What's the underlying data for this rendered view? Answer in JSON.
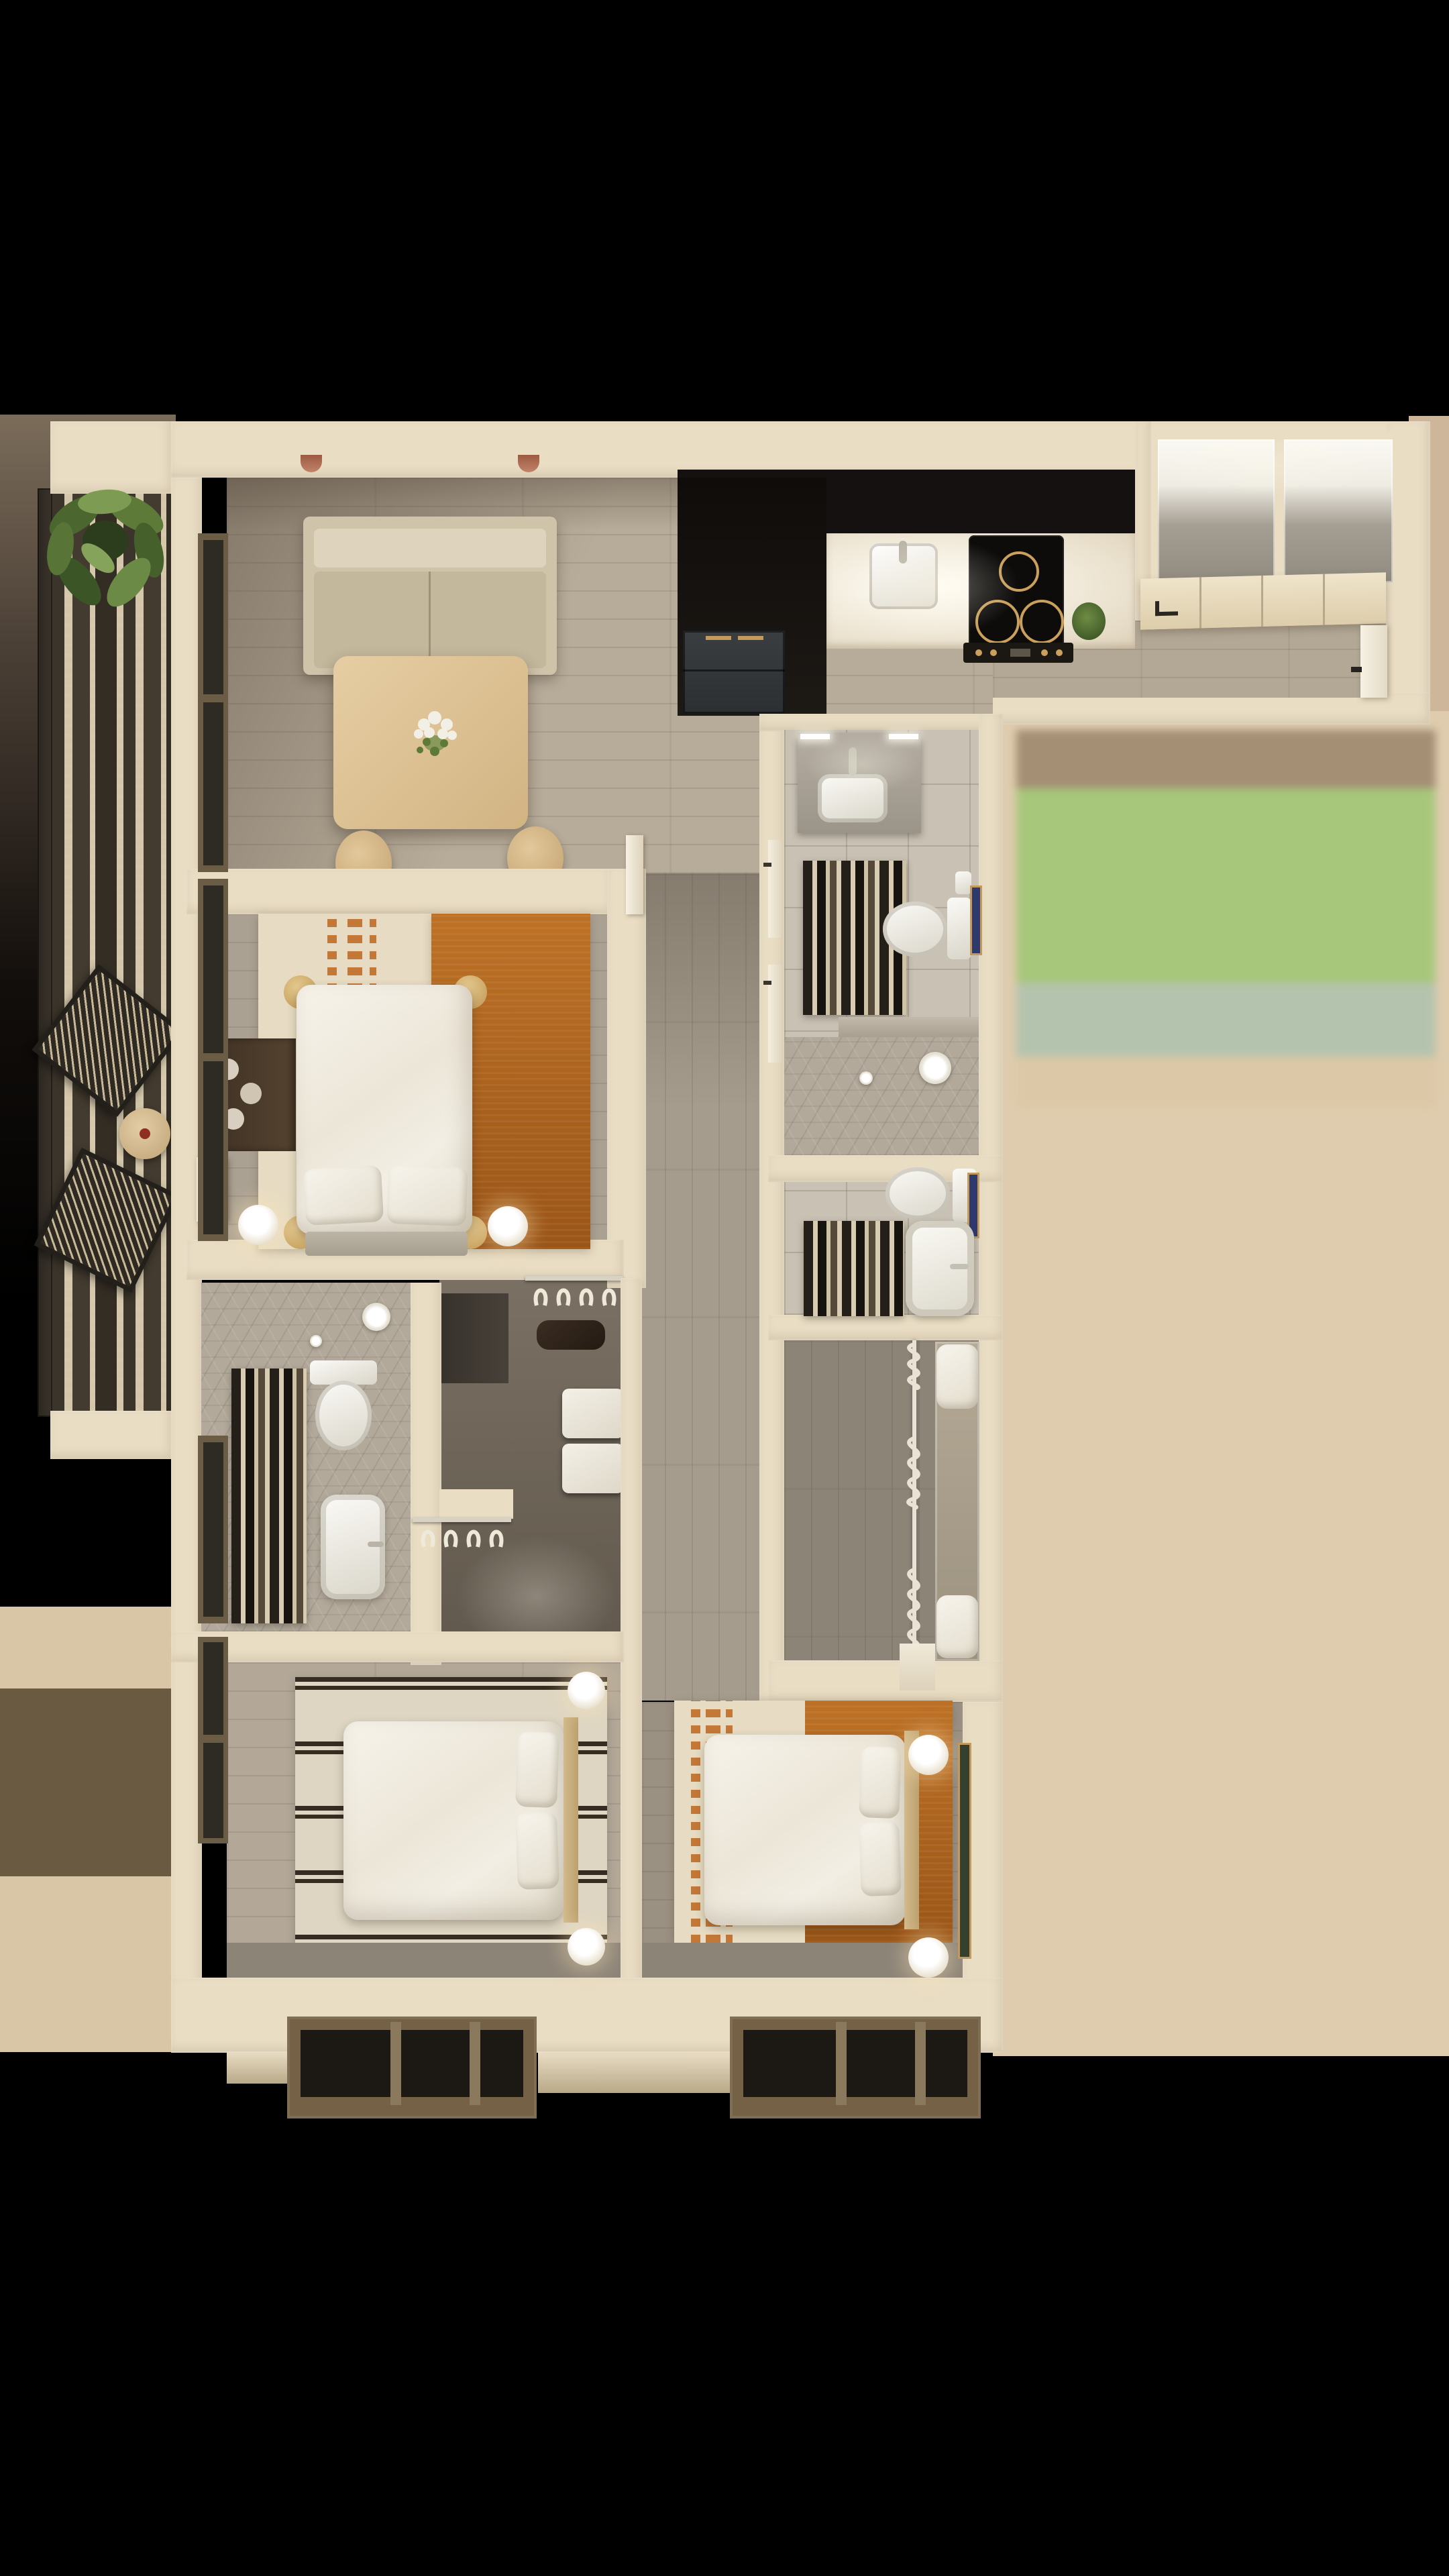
{
  "image_type": "3d-floor-plan-render",
  "palette": {
    "wall": "#e9ddc4",
    "wall-dark": "#d8c8aa",
    "wall-light": "#f7f0de",
    "floor-light": "#b7ab99",
    "floor-gray": "#a69c8d",
    "floor-br1": "#aba192",
    "floor-br3": "#9b9183",
    "floor-dark": "#6f665a",
    "floor-mid": "#8d8478",
    "tile": "#c9c2b4",
    "hex": "#b2a99b",
    "kitchen-black": "#141110",
    "appliance": "#35383b",
    "gold": "#c49a5c",
    "sofa": "#cfc3aa",
    "sofa-back": "#ded4bd",
    "sofa-seat": "#c3b79c",
    "wood-table": "#ddc398",
    "wood-head": "#d3ba8c",
    "white": "#f6f3ec",
    "rust": "#b2661f",
    "balcony-dark": "#3b342a",
    "balcony-cream": "#d3c6ab",
    "olive-frame": "#6a5c45",
    "pane": "#2e2a24",
    "plant-green": "#5d7a39",
    "plant-dark": "#3c5526",
    "court-brown": "#a48e74",
    "court-green": "#a7c77b",
    "court-sage": "#b4c3ad",
    "court-tan": "#dcc8a7",
    "bg-tan": "#dfccae",
    "bg-tan-dark": "#cdb699",
    "bg-left-brown": "#6b5a42",
    "bg-left-tan": "#d9c6a6",
    "planter": "#756246",
    "planter-dark": "#1c1813",
    "art-blue": "#2e3a6e",
    "art-green": "#36402f"
  },
  "scene": {
    "view": "top-down apartment render with black letterbox top and bottom",
    "rooms": [
      {
        "name": "balcony",
        "items": [
          "striped-deck-rug",
          "potted-plant",
          "woven-chair",
          "woven-chair",
          "round-side-table",
          "railing"
        ]
      },
      {
        "name": "living-room",
        "items": [
          "sofa",
          "wall-lamp",
          "wall-lamp",
          "dining-table",
          "flower-vase",
          "stool",
          "stool"
        ]
      },
      {
        "name": "kitchen",
        "items": [
          "tall-black-cabinets",
          "refrigerator",
          "counter",
          "sink",
          "cooktop",
          "oven-controls",
          "counter-plant"
        ]
      },
      {
        "name": "entry",
        "items": [
          "closet-cabinet",
          "closet-cabinet",
          "closet-doors",
          "entry-door"
        ]
      },
      {
        "name": "bathroom-a",
        "items": [
          "vanity-sink",
          "mirror-lights",
          "toilet",
          "paper-holder",
          "wall-art",
          "striped-rug",
          "walk-in-shower",
          "floor-drain"
        ]
      },
      {
        "name": "bathroom-b",
        "items": [
          "toilet",
          "paper-holder",
          "wall-art",
          "striped-rug",
          "bathtub",
          "faucet"
        ]
      },
      {
        "name": "mudroom-closet",
        "items": [
          "shoe-spiral-rack",
          "bench-with-cushions",
          "step"
        ]
      },
      {
        "name": "bedroom-1",
        "items": [
          "two-tone-rug",
          "double-bed",
          "pillow",
          "pillow",
          "corner-discs",
          "nightstand-lamp",
          "nightstand-lamp",
          "console-with-plates",
          "ensuite-door"
        ]
      },
      {
        "name": "ensuite-bathroom",
        "items": [
          "shower-drain",
          "striped-rug",
          "toilet",
          "basin",
          "door"
        ]
      },
      {
        "name": "wardrobe-room",
        "items": [
          "clothes-rail-with-hangers",
          "desk",
          "bag",
          "storage-boxes",
          "clothes-rail-with-hangers"
        ]
      },
      {
        "name": "corridor",
        "items": [
          "doors-to-bathrooms",
          "bedroom-door"
        ]
      },
      {
        "name": "bedroom-2",
        "items": [
          "striped-rug",
          "double-bed",
          "pillow",
          "pillow",
          "headboard",
          "nightstand-lamp",
          "nightstand-lamp",
          "window"
        ]
      },
      {
        "name": "bedroom-3",
        "items": [
          "two-tone-rug",
          "double-bed",
          "pillow",
          "pillow",
          "headboard",
          "nightstand-lamp",
          "nightstand-lamp",
          "wall-art"
        ]
      },
      {
        "name": "exterior",
        "items": [
          "courtyard-color-bands",
          "window-planter",
          "window-planter"
        ]
      }
    ]
  }
}
